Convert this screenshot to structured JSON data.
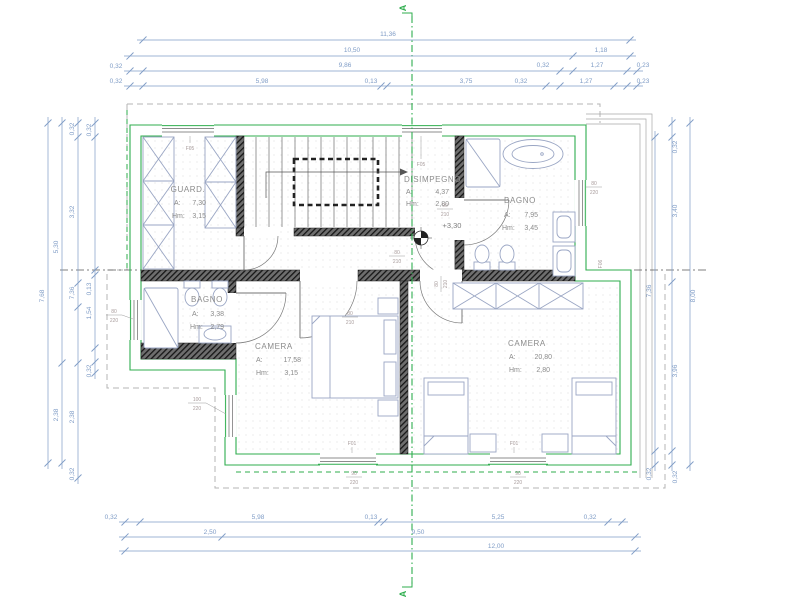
{
  "section_marker": "A",
  "level_marker": "+3,30",
  "rooms": [
    {
      "name": "GUARD.",
      "area_label": "A:",
      "area_value": "7,30",
      "height_label": "Hm:",
      "height_value": "3,15"
    },
    {
      "name": "DISIMPEGNO",
      "area_label": "A:",
      "area_value": "4,37",
      "height_label": "Hm:",
      "height_value": "2,80"
    },
    {
      "name": "BAGNO",
      "area_label": "A:",
      "area_value": "7,95",
      "height_label": "Hm:",
      "height_value": "3,45"
    },
    {
      "name": "BAGNO",
      "area_label": "A:",
      "area_value": "3,38",
      "height_label": "Hm:",
      "height_value": "2,79"
    },
    {
      "name": "CAMERA",
      "area_label": "A:",
      "area_value": "17,58",
      "height_label": "Hm:",
      "height_value": "3,15"
    },
    {
      "name": "CAMERA",
      "area_label": "A:",
      "area_value": "20,80",
      "height_label": "Hm:",
      "height_value": "2,80"
    }
  ],
  "dims_top": [
    "11,36",
    "10,50",
    "1,18",
    "0,32",
    "9,86",
    "0,32",
    "1,27",
    "0,23",
    "0,32",
    "5,98",
    "0,13",
    "3,75",
    "0,32",
    "1,27",
    "0,23"
  ],
  "dims_bottom": [
    "0,32",
    "5,98",
    "0,13",
    "5,25",
    "0,32",
    "2,50",
    "9,50",
    "12,00"
  ],
  "dims_left": [
    "0,32",
    "0,32",
    "3,32",
    "5,30",
    "7,68",
    "0,13",
    "7,36",
    "1,54",
    "0,32",
    "2,38",
    "2,38",
    "0,32"
  ],
  "dims_right": [
    "0,32",
    "3,40",
    "7,36",
    "8,00",
    "3,96",
    "0,32",
    "0,32"
  ],
  "openings": {
    "f05": "F05",
    "f01": "F01",
    "f06": "F06",
    "door80": {
      "w": "80",
      "h": "210"
    },
    "door90": {
      "w": "90",
      "h": "210"
    },
    "win80": {
      "w": "80",
      "h": "220"
    },
    "win90": {
      "w": "90",
      "h": "220"
    },
    "win100": {
      "w": "100",
      "h": "220"
    }
  },
  "colors": {
    "dimension_blue": "#7f9cc6",
    "outline_green": "#2fae4e",
    "wall_dark": "#2a2a2a",
    "furniture_blue": "#9aa6c4",
    "label_gray": "#8b8b8b"
  }
}
